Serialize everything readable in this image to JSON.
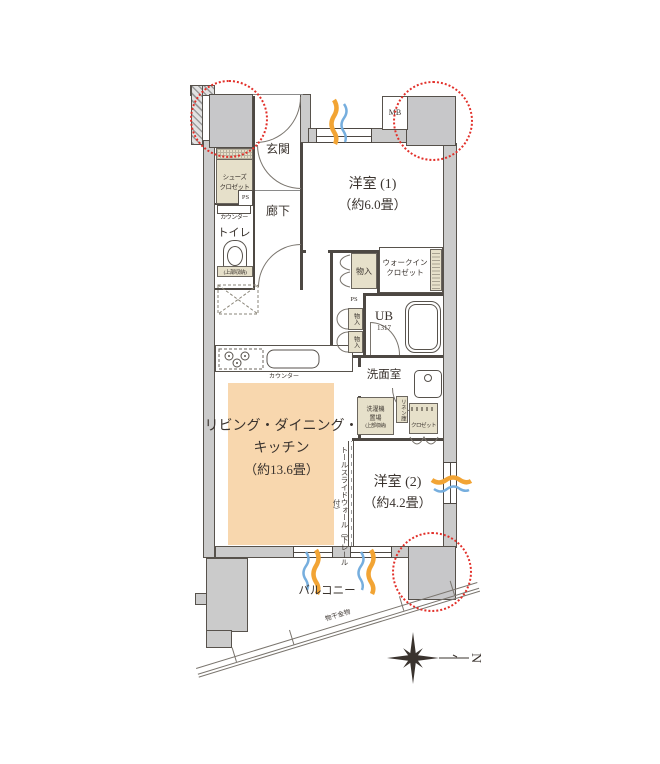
{
  "colors": {
    "accent_red": "#e2302a",
    "ldk_fill": "#f8d7ae",
    "storage_fill": "#e6e0ca",
    "wall_fill": "#cbcbcb",
    "airflow_orange": "#f2a434",
    "airflow_blue": "#76aede"
  },
  "rooms": {
    "genkan": "玄関",
    "rouka": "廊下",
    "toilet": "トイレ",
    "yoshitsu1": {
      "name": "洋室 (1)",
      "size": "（約6.0畳）"
    },
    "yoshitsu2": {
      "name": "洋室 (2)",
      "size": "（約4.2畳）"
    },
    "ldk": {
      "line1": "リビング・ダイニング・",
      "line2": "キッチン",
      "size": "（約13.6畳）"
    },
    "ub": {
      "name": "UB",
      "size": "1317"
    },
    "senmen": "洗面室",
    "balcony": "バルコニー"
  },
  "storage": {
    "shoes": {
      "line1": "シューズ",
      "line2": "クロゼット"
    },
    "monoire_hall": "物入",
    "wic": {
      "line1": "ウォークイン",
      "line2": "クロゼット"
    },
    "monoire_upper": "物入",
    "monoire_lower": "物入",
    "washer": {
      "line1": "洗濯機",
      "line2": "置場",
      "line3": "(上部収納)"
    },
    "linen": "リネン庫",
    "closet": "クロゼット"
  },
  "fixtures": {
    "mb": "MB",
    "ps_entry": "PS",
    "ps_mid": "PS",
    "counter_toilet": "カウンター",
    "counter_kitchen": "カウンター",
    "toilet_upper": "(上部収納)",
    "tall_slide_wall": "トールスライドウォール（下レール付）",
    "monohoshi": "物干金物"
  },
  "compass": {
    "north": "N"
  }
}
